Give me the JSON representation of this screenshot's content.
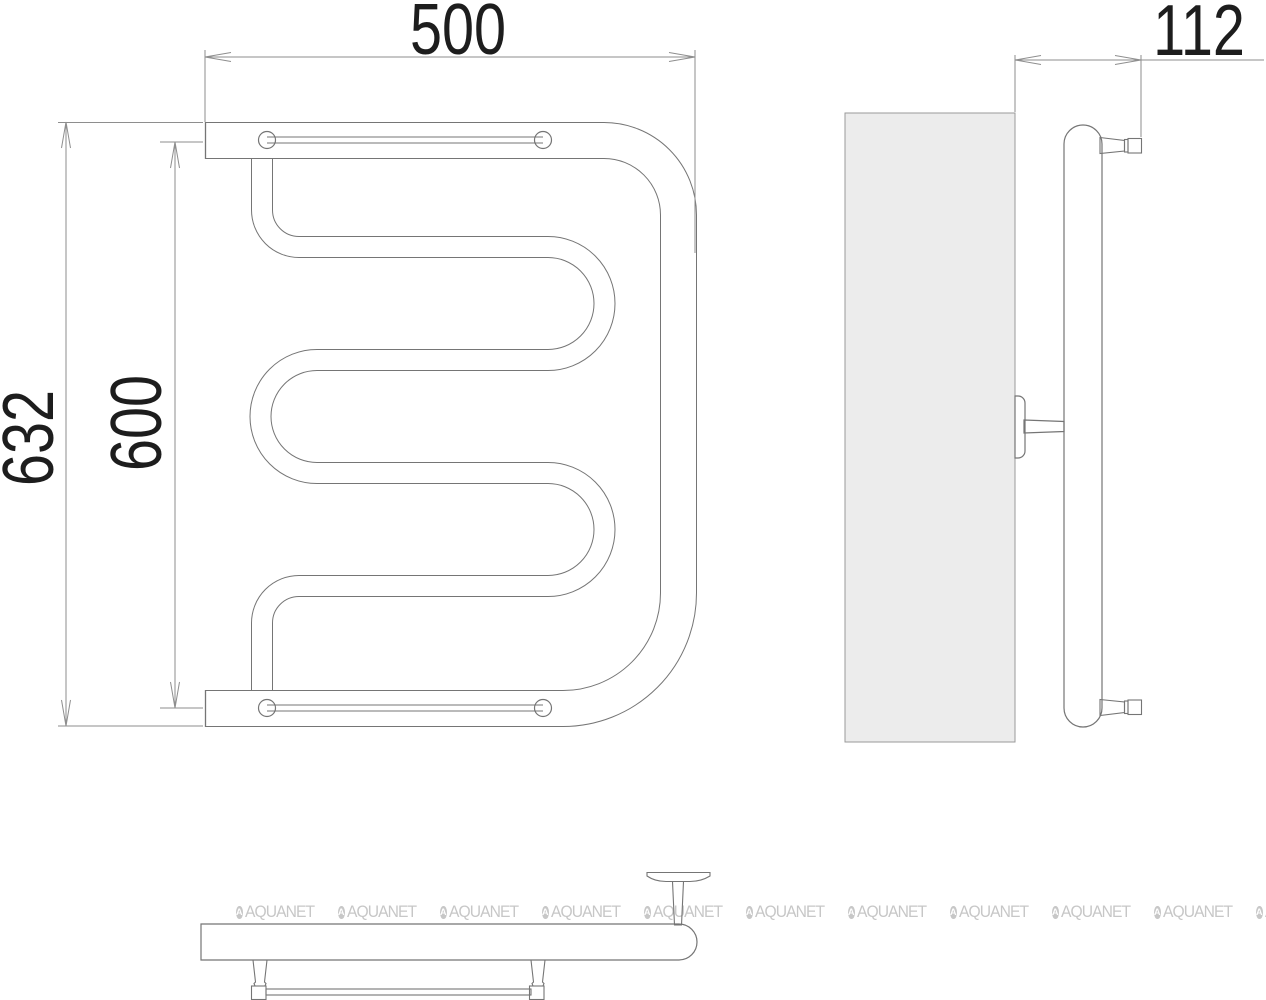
{
  "title": "towel-rail-technical-drawing",
  "dimensions": {
    "width_label": "500",
    "depth_label": "112",
    "overall_height_label": "632",
    "inner_height_label": "600"
  },
  "watermark": {
    "text": "AQUANET",
    "icon_letter": "A",
    "count": 11
  },
  "colors": {
    "geometry_line": "#757575",
    "dimension_line": "#8e8e8e",
    "dimension_text": "#1d1d1d",
    "wall_fill": "#ececec",
    "wall_stroke": "#9a9a9a",
    "watermark": "#c7c7c7",
    "background": "#ffffff"
  }
}
